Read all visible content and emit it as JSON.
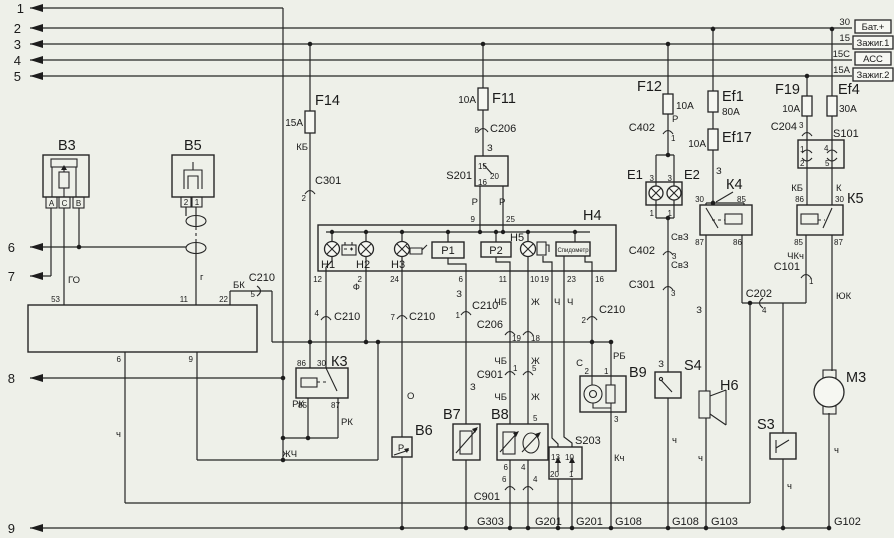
{
  "left_pins": {
    "n1": "1",
    "n2": "2",
    "n3": "3",
    "n4": "4",
    "n5": "5",
    "n6": "6",
    "n7": "7",
    "n8": "8",
    "n9": "9"
  },
  "bus": {
    "t30": "30",
    "t15": "15",
    "t15c": "15C",
    "t15a": "15A",
    "bat": "Бат.+",
    "ign1": "Зажиг.1",
    "acc": "АСС",
    "ign2": "Зажиг.2"
  },
  "fuses": {
    "f14": "F14",
    "f14_a": "15А",
    "f11": "F11",
    "f11_a": "10А",
    "f12": "F12",
    "f12_a": "10А",
    "ef1": "Ef1",
    "ef1_a": "80А",
    "ef17": "Ef17",
    "ef17_a": "10А",
    "f19": "F19",
    "f19_a": "10А",
    "ef4": "Ef4",
    "ef4_a": "30А"
  },
  "components": {
    "b3": "B3",
    "b5": "B5",
    "b6": "B6",
    "b7": "B7",
    "b8": "B8",
    "b9": "B9",
    "e1": "E1",
    "e2": "E2",
    "h1": "H1",
    "h2": "H2",
    "h3": "H3",
    "h4": "H4",
    "h5": "H5",
    "h6": "H6",
    "k3": "К3",
    "k4": "К4",
    "k5": "К5",
    "m3": "М3",
    "p1": "P1",
    "p2": "P2",
    "s3": "S3",
    "s4": "S4",
    "s101": "S101",
    "s201": "S201",
    "s203": "S203",
    "speedo": "Спидометр"
  },
  "relay_pins": {
    "p30": "30",
    "p85": "85",
    "p86": "86",
    "p87": "87"
  },
  "connectors": {
    "c206": "C206",
    "c210": "C210",
    "c301": "C301",
    "c402": "C402",
    "c901": "C901",
    "c202": "C202",
    "c101": "C101",
    "c204": "C204",
    "pins": {
      "p1": "1",
      "p2": "2",
      "p3": "3",
      "p4": "4",
      "p5": "5",
      "p6": "6",
      "p7": "7",
      "p8": "8",
      "p18": "18",
      "p19": "19"
    }
  },
  "h4_pins": {
    "p2": "2",
    "p6": "6",
    "p9": "9",
    "p10": "10",
    "p11": "11",
    "p12": "12",
    "p16": "16",
    "p19": "19",
    "p23": "23",
    "p24": "24",
    "p25": "25"
  },
  "s201_pins": {
    "p15": "15",
    "p16": "16",
    "p20": "20"
  },
  "s203_pins": {
    "p13": "13",
    "p10": "10",
    "p20": "20",
    "p1": "1"
  },
  "s101_pins": {
    "p1": "1",
    "p2": "2",
    "p4": "4",
    "p5": "5"
  },
  "b9_pins": {
    "p1": "1",
    "p2": "2",
    "p3": "3"
  },
  "b8_pins": {
    "p4": "4",
    "p5": "5",
    "p6": "6"
  },
  "b3_terminals": {
    "a": "А",
    "c": "С",
    "b": "В"
  },
  "b5_terminals": {
    "t1": "1",
    "t2": "2"
  },
  "e_pins": {
    "p3": "3",
    "p1": "1"
  },
  "ecu_pins": {
    "p6": "6",
    "p9": "9",
    "p11": "11",
    "p22": "22",
    "p53": "53"
  },
  "wires": {
    "bk": "БК",
    "kb": "КБ",
    "k": "К",
    "ch": "Ч",
    "ch_small": "ч",
    "chb": "ЧБ",
    "zh": "Ж",
    "zhch": "ЖЧ",
    "z": "З",
    "o": "О",
    "f": "Ф",
    "r": "Р",
    "rk": "РК",
    "rb": "РБ",
    "s": "С",
    "g": "г",
    "go": "ГО",
    "kch": "Кч",
    "chkch": "ЧКч",
    "yuk": "ЮК",
    "svz": "СвЗ"
  },
  "grounds": {
    "g303": "G303",
    "g201": "G201",
    "g108": "G108",
    "g103": "G103",
    "g102": "G102"
  }
}
